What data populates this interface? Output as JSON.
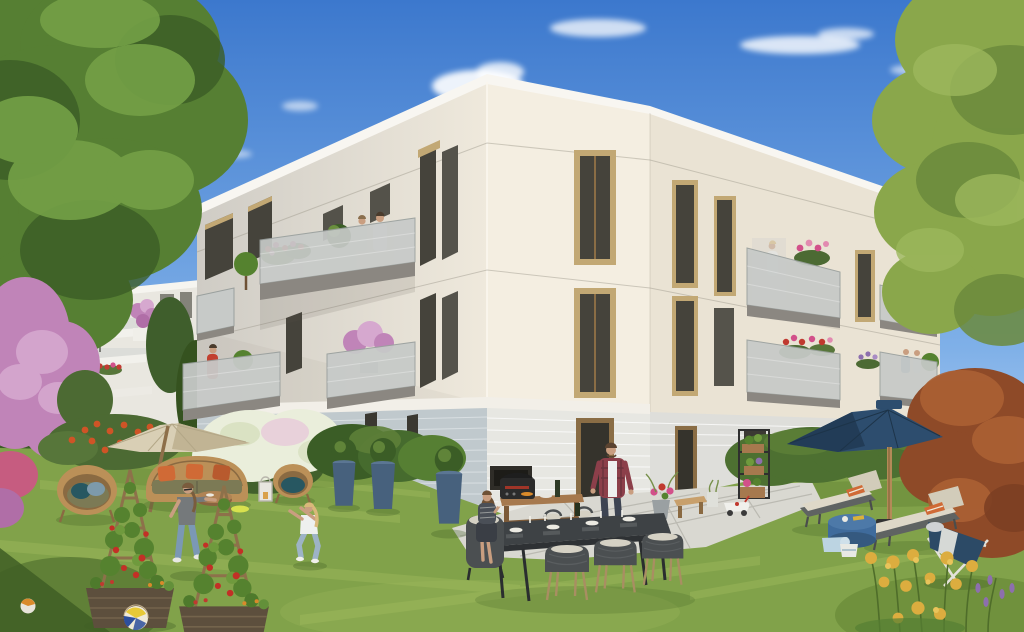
{
  "meta": {
    "kind": "architectural-exterior-render",
    "width": 1024,
    "height": 632,
    "setting": "sunny residential courtyard garden in front of a modern cream three-storey apartment building"
  },
  "scene": {
    "buildings": [
      {
        "name": "main-building",
        "floors": 3,
        "facade": "cream stucco with bronze window frames",
        "ground_floor": "grey and white brick",
        "features": "grey mesh balconies with flowers, plants and residents"
      },
      {
        "name": "background-building",
        "features": "white stacked terraces with railings, blue parasol, pink planter"
      }
    ],
    "people": [
      {
        "name": "man-on-upper-balcony",
        "clothing": "white t-shirt"
      },
      {
        "name": "woman-on-upper-balcony",
        "clothing": "cream top"
      },
      {
        "name": "woman-in-red-on-lower-balcony",
        "clothing": "red top"
      },
      {
        "name": "woman-on-right-balcony",
        "clothing": "white top"
      },
      {
        "name": "couple-on-far-right-balcony",
        "clothing": "blue shirt and white top"
      },
      {
        "name": "woman-playing-frisbee",
        "clothing": "grey t-shirt, jeans, sunglasses"
      },
      {
        "name": "girl-catching-frisbee",
        "clothing": "white top and light jeans"
      },
      {
        "name": "man-at-outdoor-kitchen",
        "clothing": "red plaid shirt over white tee"
      },
      {
        "name": "woman-seated-at-table",
        "clothing": "striped dress, holding a cup"
      }
    ],
    "garden_objects": [
      "beige cantilever parasol",
      "rattan sofa with olive cushions and three orange pillows",
      "rattan egg armchair with teal and blue pillows",
      "rattan armchair with teal cushion",
      "round wooden coffee table",
      "white candle lantern",
      "two wicker planters with tomato trellis towers",
      "volleyball",
      "yellow frisbee",
      "small ball",
      "outdoor kitchen with black grill and teak console",
      "dark dining table set for six with rope chairs",
      "blue ceramic pots with boxwood balls",
      "plant ladder with flower boxes",
      "wooden bench",
      "children ride-on toy",
      "navy patio parasol",
      "two sun loungers with orange striped pillows",
      "steel-blue drum side table",
      "light-blue toddler toys",
      "navy folding deck chair",
      "golden flower bush",
      "lavender stems"
    ],
    "vegetation": [
      "large green tree left",
      "green tree top right",
      "rust-red shrub tree right",
      "pink flowering tree",
      "orange flower bed",
      "white hydrangea bush",
      "green hedge",
      "lawn"
    ]
  },
  "colors": {
    "sky_top": "#3c78cd",
    "sky_mid": "#7fb0e8",
    "sky_horizon": "#dceaf8",
    "cloud": "#ffffff",
    "facade_sunlit": "#f4eee1",
    "facade_far": "#eae3d4",
    "facade_left_dark": "#cfccc5",
    "facade_left_light": "#efe9dc",
    "parapet": "#f8f6f1",
    "window_frame": "#8a6d45",
    "window_surround": "#c2a874",
    "glass": "#45433b",
    "brick_left": "#c0c9cd",
    "brick_right": "#e7e7e2",
    "railing": "#c7cac8",
    "soffit": "#8b8781",
    "bg_building": "#e9e7e0",
    "bg_parasol_blue": "#3a7cc9",
    "grass": "#81a24a",
    "grass_light": "#a3bd5e",
    "grass_dark": "#5a7c2f",
    "grass_shadow": "#3f5e24",
    "hedge": "#4d7031",
    "tree_green_dark": "#3b5d26",
    "tree_green": "#567f33",
    "tree_green_light": "#74a046",
    "tree_right_light": "#8aa74b",
    "tree_rust": "#8e4a28",
    "tree_rust_light": "#ab6134",
    "blossom_pink": "#c084b8",
    "blossom_pink_light": "#d6a8cf",
    "flower_orange": "#cf5426",
    "flower_white": "#eaeedb",
    "flower_red": "#c0392f",
    "flower_magenta": "#d2508a",
    "flower_yellow": "#dcad3f",
    "flower_purple": "#8d6fae",
    "parasol_beige": "#d9cfb5",
    "parasol_beige_shade": "#c1b494",
    "parasol_navy": "#2d4d6e",
    "parasol_navy_shade": "#223c57",
    "rattan": "#bb9058",
    "cushion_olive": "#7c7a55",
    "cushion_orange": "#d06a36",
    "cushion_teal": "#275761",
    "trellis_wood": "#8d714a",
    "planter_wicker": "#5d4f3d",
    "tomato": "#c23026",
    "leaf": "#55822f",
    "table_dark": "#3e4245",
    "chair_dark": "#4b4f51",
    "cushion_light": "#d5d1c4",
    "lounger_cushion": "#ded8c8",
    "lounger_frame": "#5f6362",
    "side_table_blue": "#3f6b9c",
    "pot_blue": "#47617d",
    "pot_grey": "#9aa0a2",
    "paver": "#d9d8d1",
    "paver_gap": "#b8b7af",
    "wood": "#a6794e",
    "bbq_dark": "#2b2b2b",
    "ball_yellow": "#e7c937",
    "ball_blue": "#2d4f9c",
    "frisbee": "#d8e14e",
    "skin": "#c99e80",
    "denim": "#7b98b4",
    "shirt_grey": "#75797b",
    "shirt_white": "#eef0ef",
    "shirt_red": "#c2402f",
    "plaid": "#8c3f4a",
    "hair_brown": "#6e5135",
    "hair_blond": "#d9b87a",
    "toy_blue": "#bcd4e2",
    "deckchair_navy": "#2c4a66",
    "deckchair_frame": "#e4e2da"
  }
}
